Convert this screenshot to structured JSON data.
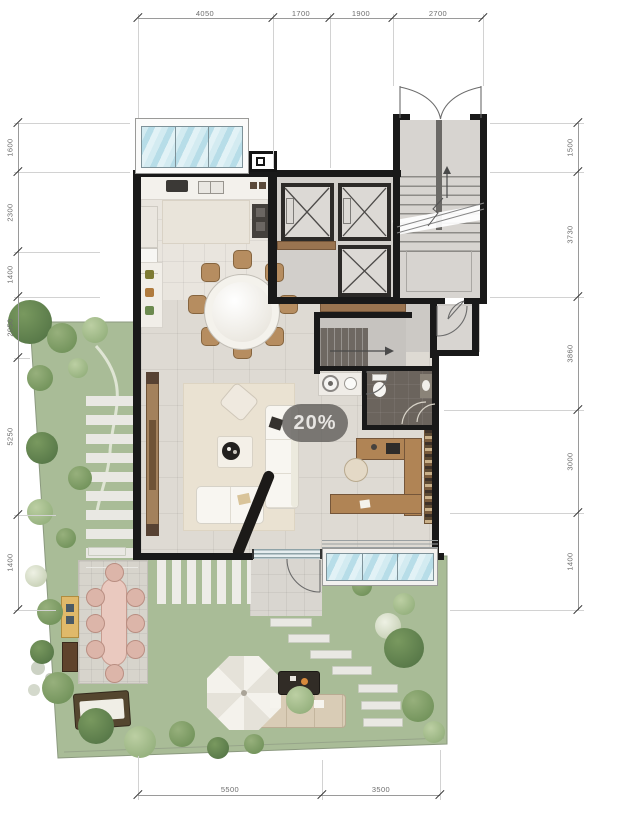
{
  "overlay": {
    "zoom_badge": "20%"
  },
  "dimensions": {
    "top": [
      "4050",
      "1700",
      "1900",
      "2700"
    ],
    "bottom": [
      "5500",
      "3500"
    ],
    "left": [
      "1600",
      "2300",
      "1400",
      "2050",
      "5250",
      "1400"
    ],
    "right": [
      "1500",
      "3730",
      "3860",
      "3000",
      "1400"
    ]
  },
  "colors": {
    "lawn": "#a9bc97",
    "wall": "#191919",
    "glass": "#c5e3ea",
    "wood": "#9a7450",
    "stepping_stone": "#e9e8e3"
  }
}
